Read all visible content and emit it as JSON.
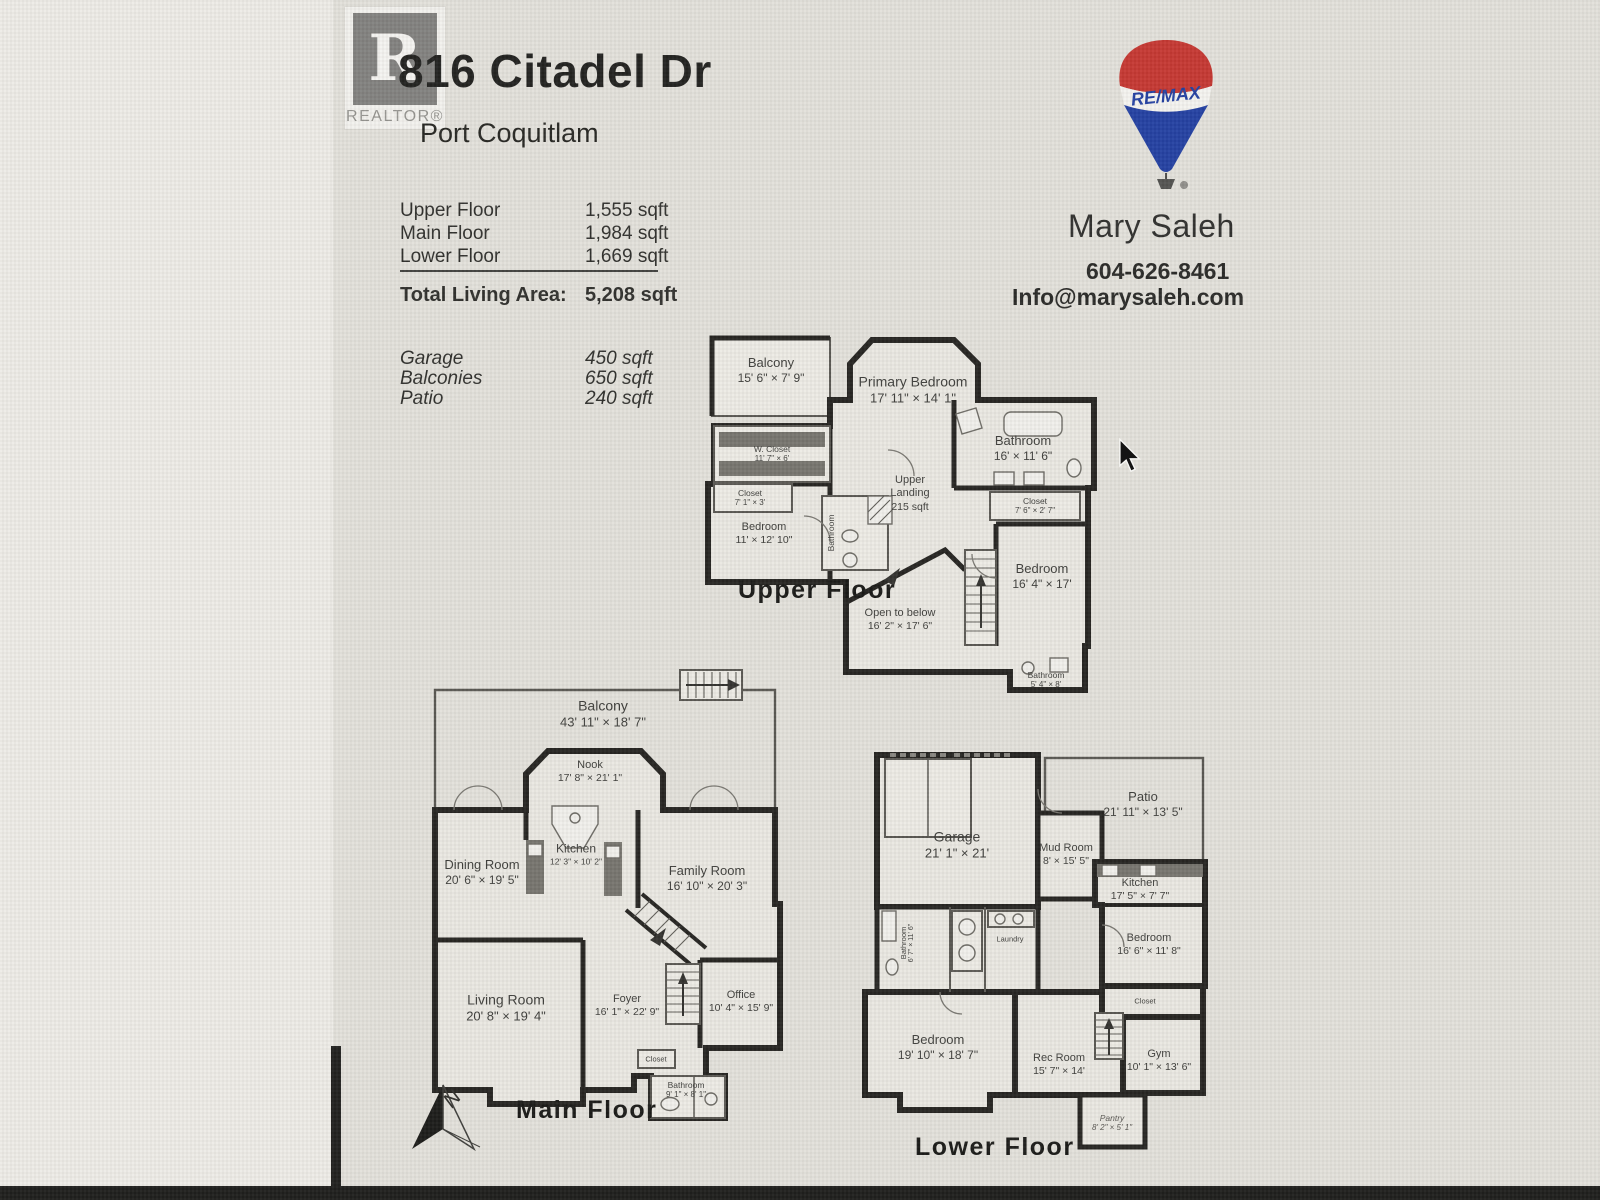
{
  "page": {
    "realtor_r": "R",
    "realtor_badge": "REALTOR®",
    "title": "816 Citadel Dr",
    "subtitle": "Port Coquitlam"
  },
  "areas": {
    "rows": [
      {
        "label": "Upper Floor",
        "value": "1,555 sqft"
      },
      {
        "label": "Main Floor",
        "value": "1,984 sqft"
      },
      {
        "label": "Lower Floor",
        "value": "1,669 sqft"
      }
    ],
    "total": {
      "label": "Total Living Area:",
      "value": "5,208 sqft"
    },
    "extras": [
      {
        "label": "Garage",
        "value": "450 sqft"
      },
      {
        "label": "Balconies",
        "value": "650 sqft"
      },
      {
        "label": "Patio",
        "value": "240 sqft"
      }
    ]
  },
  "agent": {
    "brand": "RE/MAX",
    "name": "Mary Saleh",
    "phone": "604-626-8461",
    "email": "Info@marysaleh.com"
  },
  "brand_colors": {
    "remax_red": "#c4332d",
    "remax_blue": "#1e3ca0"
  },
  "compass": {
    "label": "N"
  },
  "floors": {
    "upper": {
      "label": "Upper Floor",
      "rooms": {
        "balcony": {
          "name": "Balcony",
          "dims": "15' 6\" × 7' 9\""
        },
        "primary": {
          "name": "Primary Bedroom",
          "dims": "17' 11\" × 14' 1\""
        },
        "bathroom": {
          "name": "Bathroom",
          "dims": "16' × 11' 6\""
        },
        "wcloset": {
          "name": "W. Closet",
          "dims": "11' 7\" × 6'"
        },
        "closet": {
          "name": "Closet",
          "dims": "7' 1\" × 3'"
        },
        "bedroom_left": {
          "name": "Bedroom",
          "dims": "11' × 12' 10\""
        },
        "landing": {
          "name": "Upper Landing",
          "dims": "215 sqft"
        },
        "closet2": {
          "name": "Closet",
          "dims": "7' 6\" × 2' 7\""
        },
        "bedroom_right": {
          "name": "Bedroom",
          "dims": "16' 4\" × 17'"
        },
        "open": {
          "name": "Open to below",
          "dims": "16' 2\" × 17' 6\""
        },
        "bath_small": {
          "name": "Bathroom",
          "dims": "5' 4\" × 8'"
        },
        "bath_mid": {
          "name": "Bathroom"
        }
      }
    },
    "main": {
      "label": "Main Floor",
      "rooms": {
        "balcony": {
          "name": "Balcony",
          "dims": "43' 11\" × 18' 7\""
        },
        "nook": {
          "name": "Nook",
          "dims": "17' 8\" × 21' 1\""
        },
        "dining": {
          "name": "Dining Room",
          "dims": "20' 6\" × 19' 5\""
        },
        "kitchen": {
          "name": "Kitchen",
          "dims": "12' 3\" × 10' 2\""
        },
        "family": {
          "name": "Family Room",
          "dims": "16' 10\" × 20' 3\""
        },
        "living": {
          "name": "Living Room",
          "dims": "20' 8\" × 19' 4\""
        },
        "foyer": {
          "name": "Foyer",
          "dims": "16' 1\" × 22' 9\""
        },
        "office": {
          "name": "Office",
          "dims": "10' 4\" × 15' 9\""
        },
        "bathroom": {
          "name": "Bathroom",
          "dims": "9' 1\" × 8' 1\""
        },
        "closet": {
          "name": "Closet"
        }
      }
    },
    "lower": {
      "label": "Lower Floor",
      "rooms": {
        "garage": {
          "name": "Garage",
          "dims": "21' 1\" × 21'"
        },
        "patio": {
          "name": "Patio",
          "dims": "21' 11\" × 13' 5\""
        },
        "mud": {
          "name": "Mud Room",
          "dims": "8' × 15' 5\""
        },
        "kitchen": {
          "name": "Kitchen",
          "dims": "17' 5\" × 7' 7\""
        },
        "bedroom_right": {
          "name": "Bedroom",
          "dims": "16' 6\" × 11' 8\""
        },
        "bathroom": {
          "name": "Bathroom",
          "dims": "6' 7\" × 11' 6\""
        },
        "laundry": {
          "name": "Laundry"
        },
        "closet": {
          "name": "Closet"
        },
        "bedroom_left": {
          "name": "Bedroom",
          "dims": "19' 10\" × 18' 7\""
        },
        "rec": {
          "name": "Rec Room",
          "dims": "15' 7\" × 14'"
        },
        "gym": {
          "name": "Gym",
          "dims": "10' 1\" × 13' 6\""
        },
        "pantry": {
          "name": "Pantry",
          "dims": "8' 2\" × 5' 1\""
        }
      }
    }
  }
}
